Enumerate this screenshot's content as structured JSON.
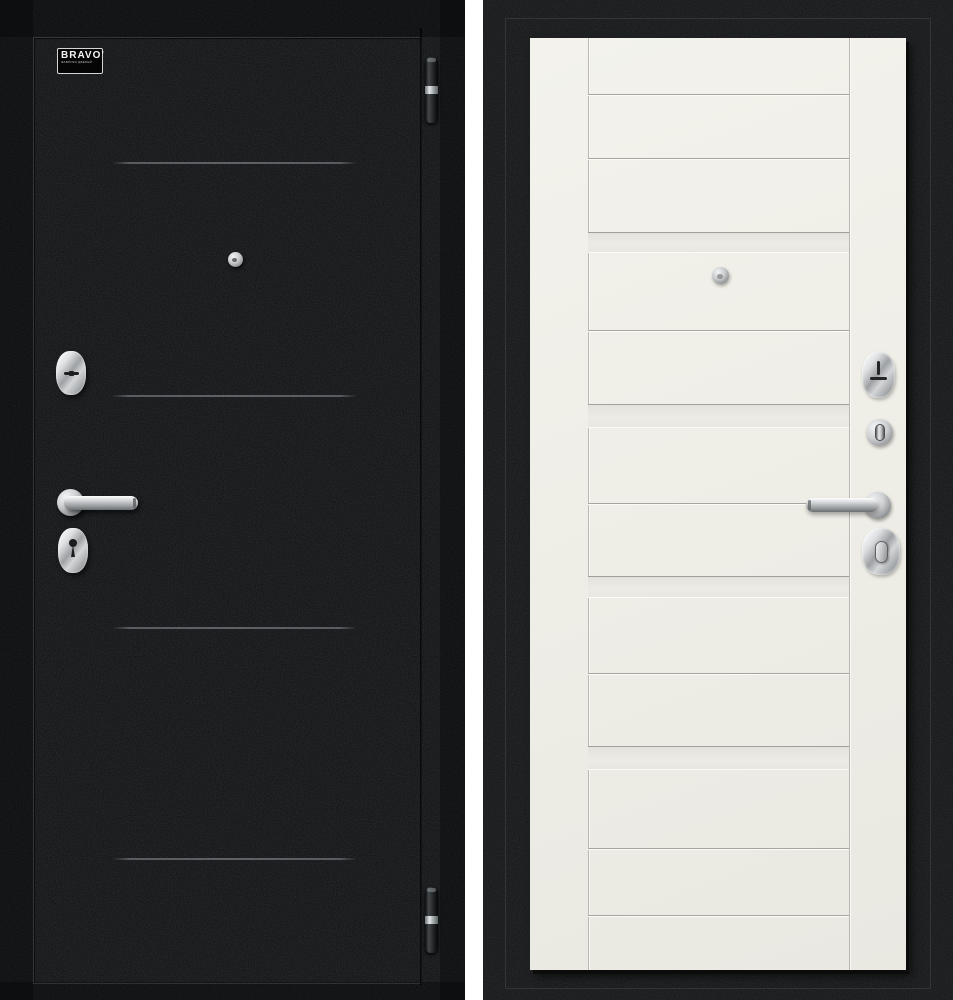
{
  "page": {
    "background": "#ffffff"
  },
  "brand": {
    "name": "BRAVO'",
    "tagline": "ФАБРИКА ДВЕРЕЙ"
  },
  "left_door_view": {
    "label": "exterior-black-side",
    "surface_color": "#0d0f11",
    "groove_color": "#63676b",
    "groove_lines": [
      {
        "y": 162,
        "x1": 112,
        "x2": 357
      },
      {
        "y": 395,
        "x1": 111,
        "x2": 357
      },
      {
        "y": 627,
        "x1": 112,
        "x2": 357
      },
      {
        "y": 858,
        "x1": 112,
        "x2": 357
      }
    ],
    "hinges_y": [
      57,
      887
    ],
    "peephole": {
      "x": 235,
      "y": 259
    }
  },
  "right_door_view": {
    "label": "interior-white-side",
    "leaf_color": "#efeee7",
    "frame_color": "#111314",
    "leaf_rect": {
      "x": 530,
      "y": 38,
      "w": 376,
      "h": 932
    },
    "stile_grooves_x": [
      588,
      849
    ],
    "panel_grooves_y": [
      94,
      158,
      330,
      503,
      673,
      848,
      915
    ],
    "panel_rails": [
      [
        232,
        253
      ],
      [
        404,
        428
      ],
      [
        576,
        598
      ],
      [
        746,
        770
      ]
    ],
    "peephole": {
      "x": 720,
      "y": 275
    }
  },
  "hardware_finish": {
    "chrome_light": "#f6f7f8",
    "chrome_mid": "#c0c3c5",
    "chrome_dark": "#84878a"
  }
}
